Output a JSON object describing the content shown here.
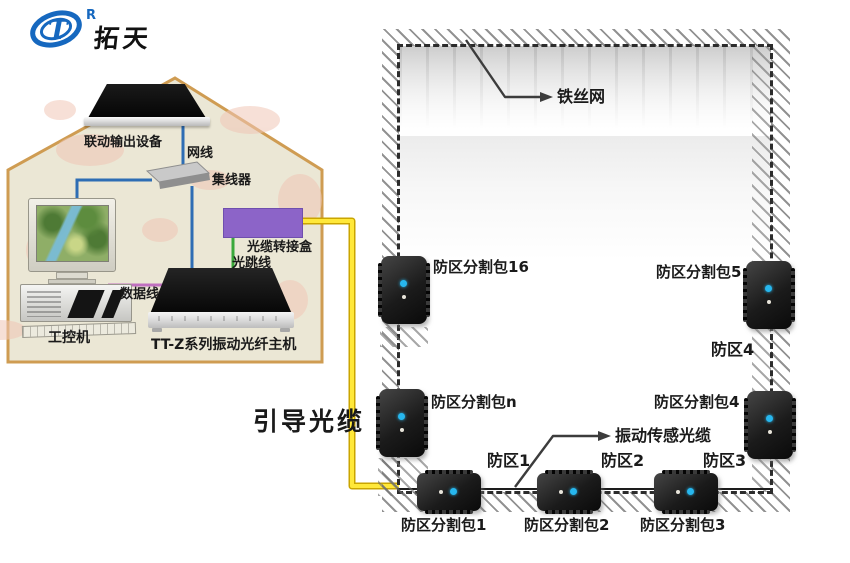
{
  "logo": {
    "registered_mark": "R",
    "brand_name": "拓天"
  },
  "control_room": {
    "linkage_output_label": "联动输出设备",
    "network_cable_label": "网线",
    "hub_label": "集线器",
    "junction_box_label": "光缆转接盒",
    "fiber_jumper_label": "光跳线",
    "data_cable_label": "数据线",
    "industrial_pc_label": "工控机",
    "host_label": "TT-Z系列振动光纤主机"
  },
  "guide_cable_label": "引导光缆",
  "fence": {
    "mesh_label": "铁丝网",
    "sensor_cable_label": "振动传感光缆",
    "left_packs": [
      {
        "label": "防区分割包16"
      },
      {
        "label": "防区分割包n"
      }
    ],
    "right_packs": [
      {
        "label": "防区分割包5"
      },
      {
        "label": "防区分割包4"
      }
    ],
    "bottom_packs": [
      {
        "label": "防区分割包1"
      },
      {
        "label": "防区分割包2"
      },
      {
        "label": "防区分割包3"
      }
    ],
    "zone_labels": [
      {
        "label": "防区1"
      },
      {
        "label": "防区2"
      },
      {
        "label": "防区3"
      },
      {
        "label": "防区4"
      }
    ]
  },
  "colors": {
    "guide_cable_yellow": "#ffe400",
    "network_line_blue": "#2e6db4",
    "fiber_jumper_green": "#3aa83a",
    "data_line_purple": "#c070c0",
    "junction_box_purple": "#8c64c8",
    "house_border_tan": "#cf9c52",
    "house_fill": "#ebe7d5",
    "led_cyan": "#27b7ee"
  }
}
